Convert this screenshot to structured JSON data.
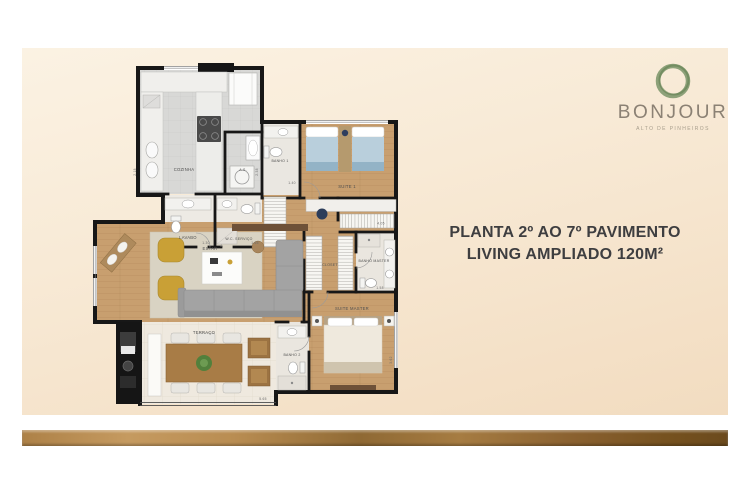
{
  "logo": {
    "brand": "BONJOUR",
    "tagline": "ALTO DE PINHEIROS",
    "ring_color": "#7a9468",
    "text_color": "#8b8174"
  },
  "title": {
    "line1": "PLANTA 2º AO 7º PAVIMENTO",
    "line2": "LIVING AMPLIADO 120M²",
    "color": "#3e3e40"
  },
  "floorplan": {
    "rooms": {
      "cozinha": {
        "label": "COZINHA",
        "dim": "2.18"
      },
      "as": {
        "label": "A.S.",
        "dim": "2.38"
      },
      "banho1": {
        "label": "BANHO 1",
        "dim": "1.40"
      },
      "suite1": {
        "label": "SUITE 1",
        "dim": "4.05"
      },
      "lavabo": {
        "label": "LAVABO",
        "dim": "1.30"
      },
      "wc_servico": {
        "label": "W.C. SERVIÇO",
        "dim": "1.65"
      },
      "estar": {
        "label": "ESTAR"
      },
      "closet": {
        "label": "CLOSET"
      },
      "banho_master": {
        "label": "BANHO MASTER",
        "dim": "1.58"
      },
      "suite_master": {
        "label": "SUITE MASTER",
        "dim": "3.62"
      },
      "banho2": {
        "label": "BANHO 2"
      },
      "terraco": {
        "label": "TERRAÇO",
        "dim": "5.65"
      }
    }
  },
  "colors": {
    "panel_top": "#fbf2e3",
    "panel_bottom": "#f2dcc0",
    "bar_bronze": "#8f6934",
    "wall": "#171717",
    "wood_floor": "#c89f6f",
    "gray_tile": "#d8d8d6",
    "bed_blue": "#b9cfdc",
    "armchair_mustard": "#c9a036"
  }
}
